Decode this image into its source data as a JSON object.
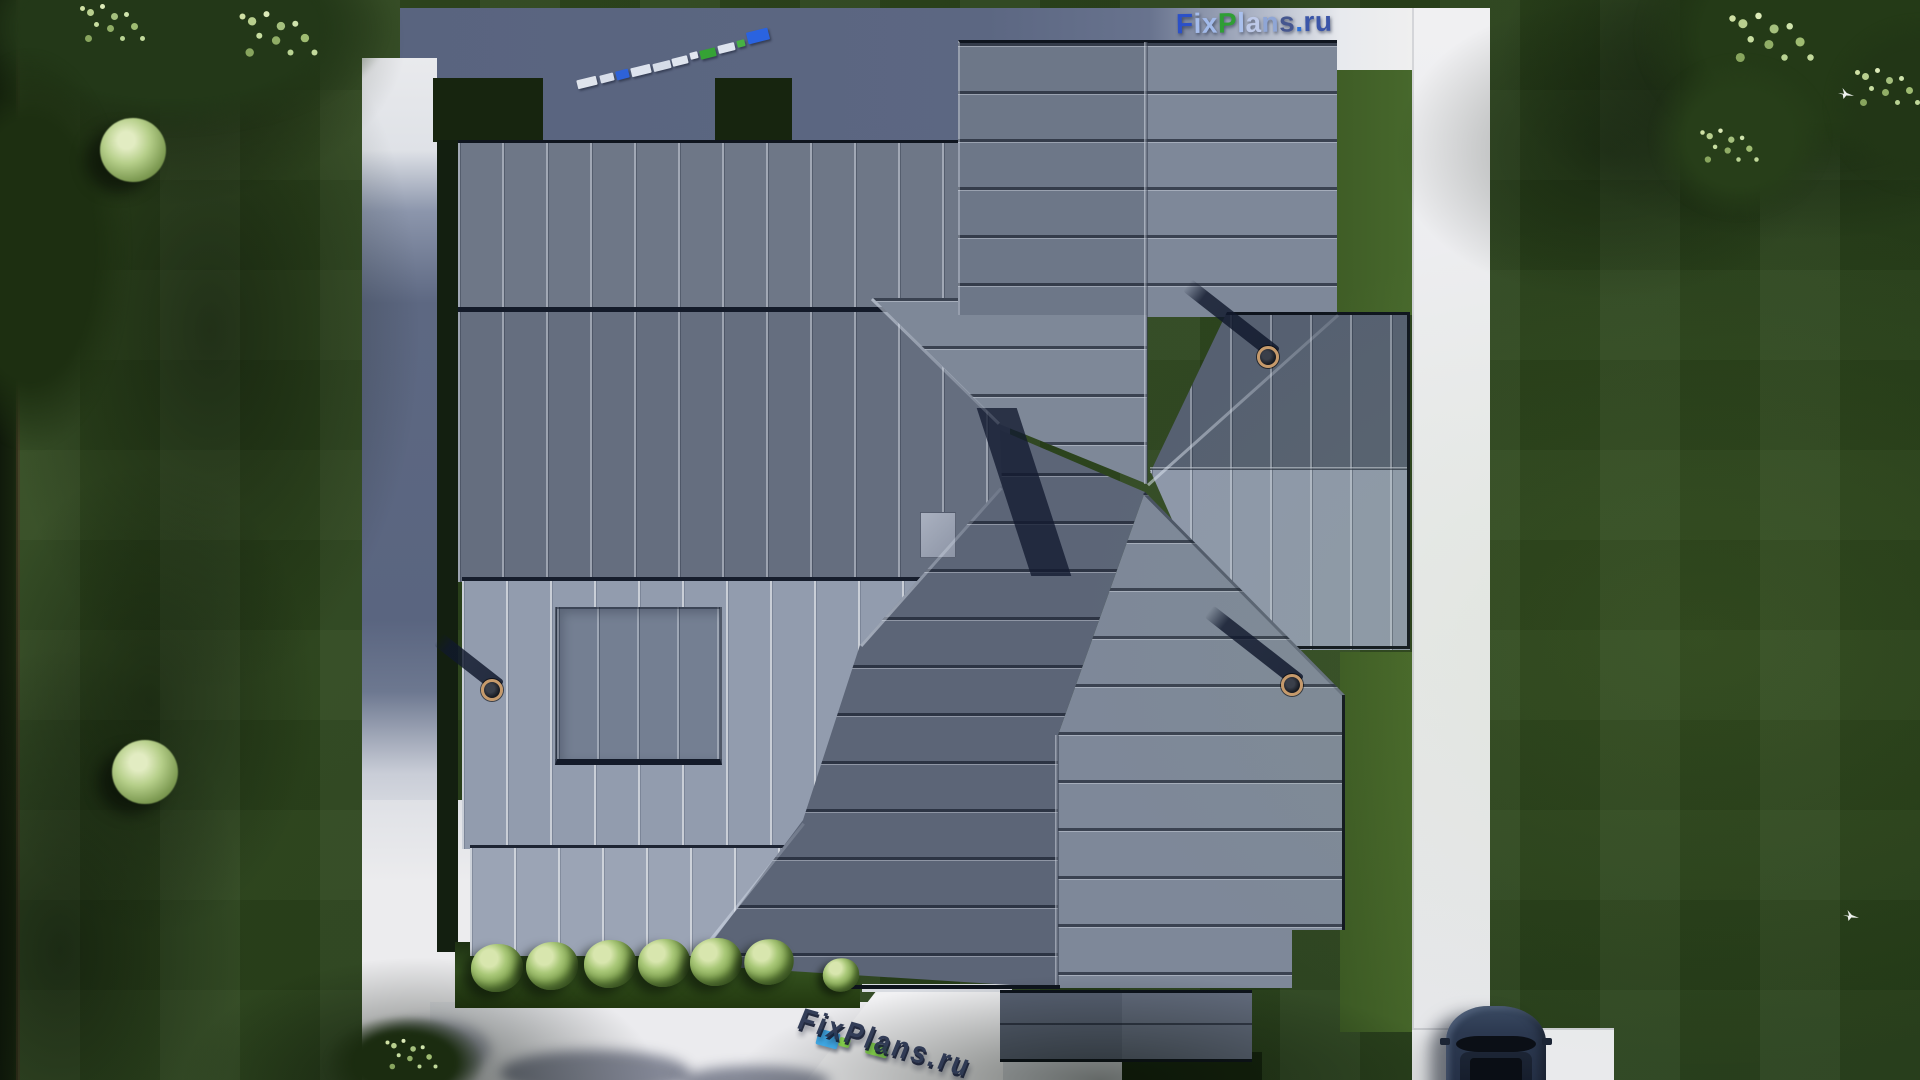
{
  "site": {
    "brand": "FixPlans.ru"
  },
  "watermark": {
    "logo_text": "FixPlans.ru",
    "letters": [
      {
        "ch": "F",
        "style": "color:#2b50c8"
      },
      {
        "ch": "i",
        "style": "color:#a6bdec"
      },
      {
        "ch": "x",
        "style": "color:#a2baea"
      },
      {
        "ch": "P",
        "style": "color:#2f9e35"
      },
      {
        "ch": "l",
        "style": "color:#aac1ee"
      },
      {
        "ch": "a",
        "style": "color:#bdc9e8"
      },
      {
        "ch": "n",
        "style": "color:#8fa6d6"
      },
      {
        "ch": "s",
        "style": "color:#45568f"
      },
      {
        "ch": ".",
        "style": "color:#2e6fd6"
      },
      {
        "ch": "r",
        "style": "color:#3b55a8"
      },
      {
        "ch": "u",
        "style": "color:#3b55a8"
      }
    ],
    "bottom_text": "FixPlans.ru",
    "mini_blocks": [
      {
        "x": 577,
        "y": 78,
        "w": 20,
        "h": 9,
        "c": "#dfe4ec",
        "r": -14
      },
      {
        "x": 600,
        "y": 74,
        "w": 14,
        "h": 8,
        "c": "#d8deea",
        "r": -14
      },
      {
        "x": 616,
        "y": 70,
        "w": 13,
        "h": 9,
        "c": "#2e62d8",
        "r": -14
      },
      {
        "x": 631,
        "y": 66,
        "w": 20,
        "h": 9,
        "c": "#dde3ee",
        "r": -14
      },
      {
        "x": 653,
        "y": 62,
        "w": 18,
        "h": 8,
        "c": "#d5dce8",
        "r": -14
      },
      {
        "x": 672,
        "y": 57,
        "w": 16,
        "h": 8,
        "c": "#dfe5ef",
        "r": -14
      },
      {
        "x": 690,
        "y": 52,
        "w": 8,
        "h": 7,
        "c": "#e2e7f0",
        "r": -14
      },
      {
        "x": 700,
        "y": 49,
        "w": 16,
        "h": 9,
        "c": "#35a235",
        "r": -14
      },
      {
        "x": 718,
        "y": 44,
        "w": 17,
        "h": 8,
        "c": "#dde3ee",
        "r": -14
      },
      {
        "x": 737,
        "y": 40,
        "w": 8,
        "h": 7,
        "c": "#47b143",
        "r": -14
      },
      {
        "x": 747,
        "y": 30,
        "w": 22,
        "h": 12,
        "c": "#2a63e0",
        "r": -14
      }
    ],
    "bottom_blocks": [
      {
        "style": "left:817px;top:1031px;width:22px;height:16px;background:#3fa8e4"
      },
      {
        "style": "left:839px;top:1038px;width:11px;height:9px;background:#8ad84e"
      },
      {
        "style": "left:866px;top:1044px;width:22px;height:12px;background:#85d44a"
      }
    ]
  },
  "palette": {
    "roof_north_slope": "#6e7787",
    "roof_mid_slope": "#656e7f",
    "roof_south_slope": "#929cae",
    "roof_dark_slope": "#566071",
    "roof_eave_line": "#10161f",
    "grass_base": "#2c451c",
    "grass_lit_strip": "#47682c",
    "path_white": "#ececee",
    "path_in_shadow": "#5c6782",
    "accent_blue": "#2a63e0",
    "accent_green": "#35a235",
    "car_body": "#2c3950"
  },
  "decor": {
    "bushes": [
      {
        "x": 497,
        "y": 968,
        "s": 1
      },
      {
        "x": 552,
        "y": 966,
        "s": 1
      },
      {
        "x": 610,
        "y": 964,
        "s": 1
      },
      {
        "x": 664,
        "y": 963,
        "s": 1
      },
      {
        "x": 716,
        "y": 962,
        "s": 1
      },
      {
        "x": 768,
        "y": 961,
        "s": 0.95
      },
      {
        "x": 833,
        "y": 968,
        "s": 0.7
      }
    ],
    "chimneys": [
      {
        "x": 1268,
        "y": 357,
        "shadow_len": 112,
        "shadow_rot": 38
      },
      {
        "x": 1292,
        "y": 685,
        "shadow_len": 115,
        "shadow_rot": 38
      },
      {
        "x": 492,
        "y": 690,
        "shadow_len": 78,
        "shadow_rot": 38
      }
    ],
    "birds": [
      {
        "x": 1838,
        "y": 88
      },
      {
        "x": 1843,
        "y": 910
      }
    ]
  }
}
